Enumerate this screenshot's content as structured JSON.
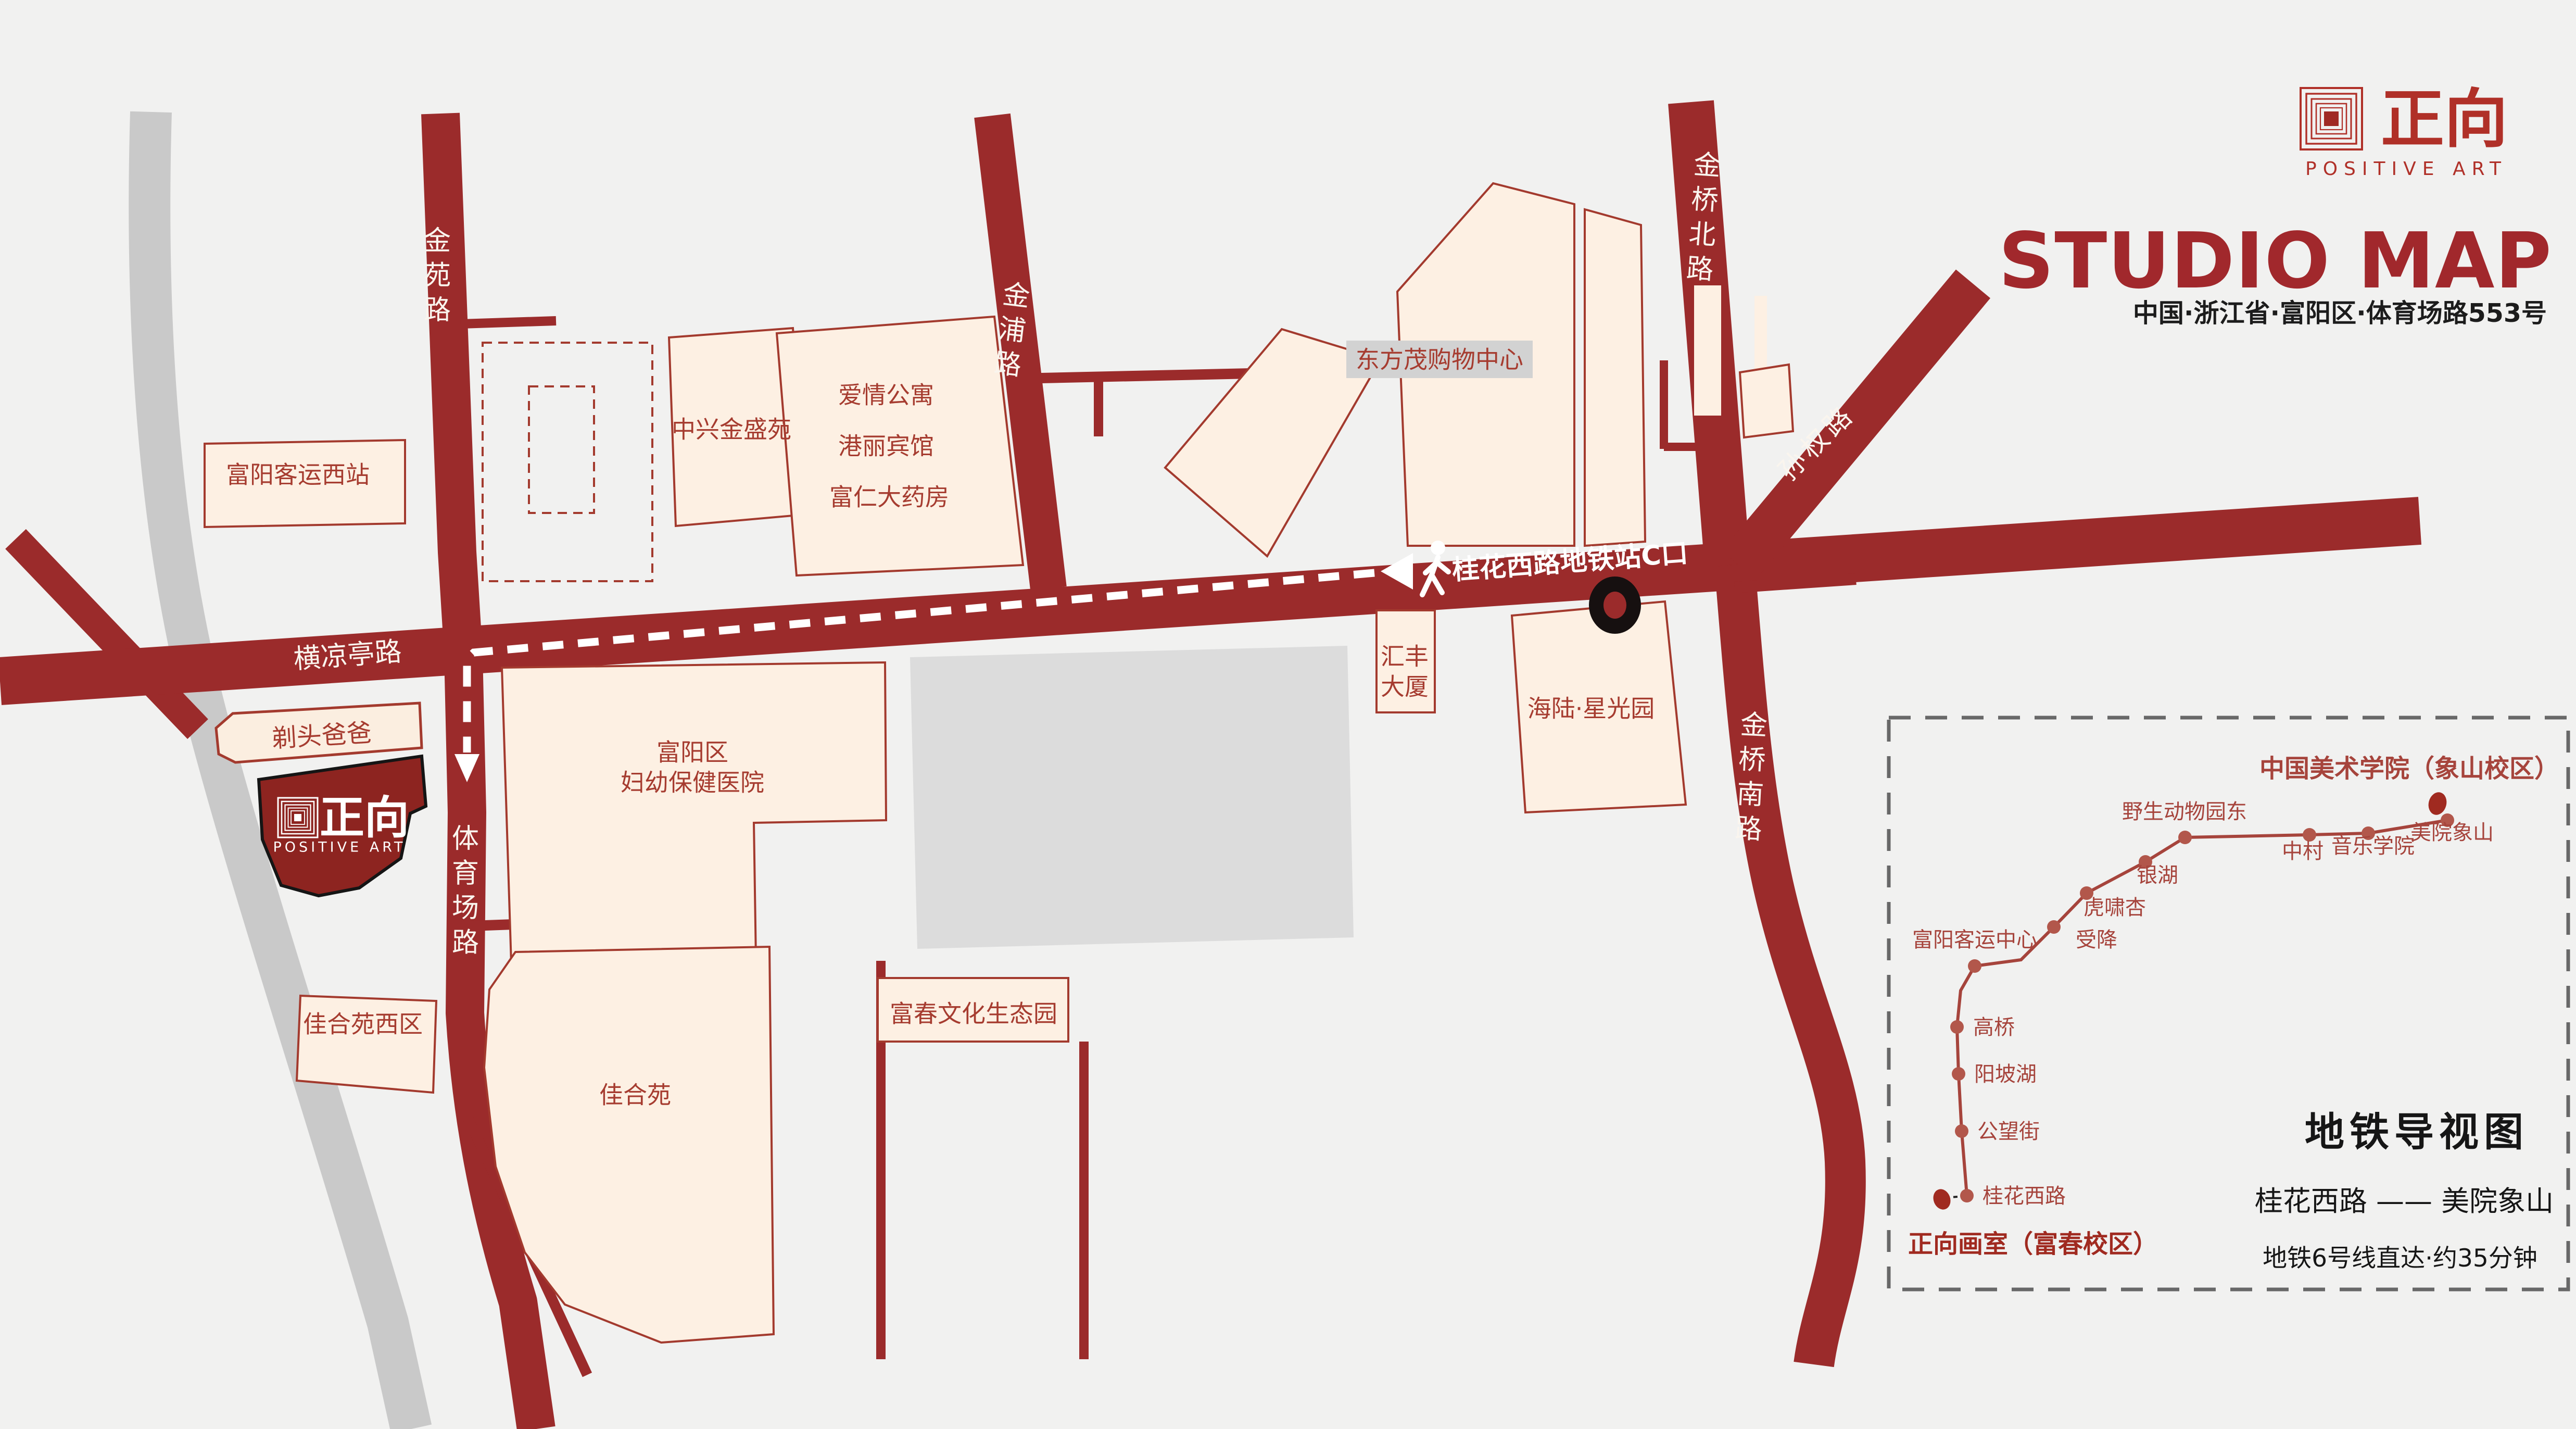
{
  "header": {
    "logo": {
      "icon": "concentric-squares-logo",
      "name_cn": "正向",
      "name_en": "POSITIVE ART"
    },
    "title": "STUDIO MAP",
    "address": "中国·浙江省·富阳区·体育场路553号"
  },
  "colors": {
    "background": "#f1f1f0",
    "road_red": "#9b2b2b",
    "building_fill": "#fdf0e3",
    "building_stroke": "#a33a2e",
    "label_red": "#a63c30",
    "brand_red": "#a1282c",
    "river_gray": "#c9c9c9",
    "block_gray": "#dcdcdc",
    "label_bg_gray": "#d2d2d2",
    "studio_block_fill": "#8d2420"
  },
  "roads": {
    "jinyuan": "金苑路",
    "jinpu": "金浦路",
    "jinqiao_north": "金桥北路",
    "sunquan": "孙权路",
    "jinqiao_south": "金桥南路",
    "tiyuchang": "体育场路",
    "hengliangting": "横凉亭路"
  },
  "route": {
    "exit_label": "桂花西路地铁站C口",
    "icons": [
      "left-arrow-icon",
      "walking-person-icon",
      "metro-exit-dot"
    ]
  },
  "places": {
    "bus_station_west": "富阳客运西站",
    "zhongxing_jinsheng": "中兴金盛苑",
    "apartment_block": [
      "爱情公寓",
      "港丽宾馆",
      "富仁大药房"
    ],
    "dongfangmao": "东方茂购物中心",
    "huifeng_tower": [
      "汇丰",
      "大厦"
    ],
    "hailu_xingguang": "海陆·星光园",
    "hospital": [
      "富阳区",
      "妇幼保健医院"
    ],
    "titou_baba": "剃头爸爸",
    "jiaheyuan_west": "佳合苑西区",
    "jiaheyuan": "佳合苑",
    "fuchun_park": "富春文化生态园"
  },
  "studio": {
    "name_cn": "正向",
    "name_en": "POSITIVE ART"
  },
  "metro_inset": {
    "title": "地铁导视图",
    "terminus_top": "中国美术学院（象山校区）",
    "terminus_bottom": "正向画室（富春校区）",
    "route_summary": "桂花西路 —— 美院象山",
    "note": "地铁6号线直达·约35分钟",
    "line_name_hint": "地铁6号线",
    "stations": [
      "桂花西路",
      "公望街",
      "阳坡湖",
      "高桥",
      "富阳客运中心",
      "受降",
      "虎啸杏",
      "银湖",
      "野生动物园东",
      "中村",
      "音乐学院",
      "美院象山"
    ]
  }
}
